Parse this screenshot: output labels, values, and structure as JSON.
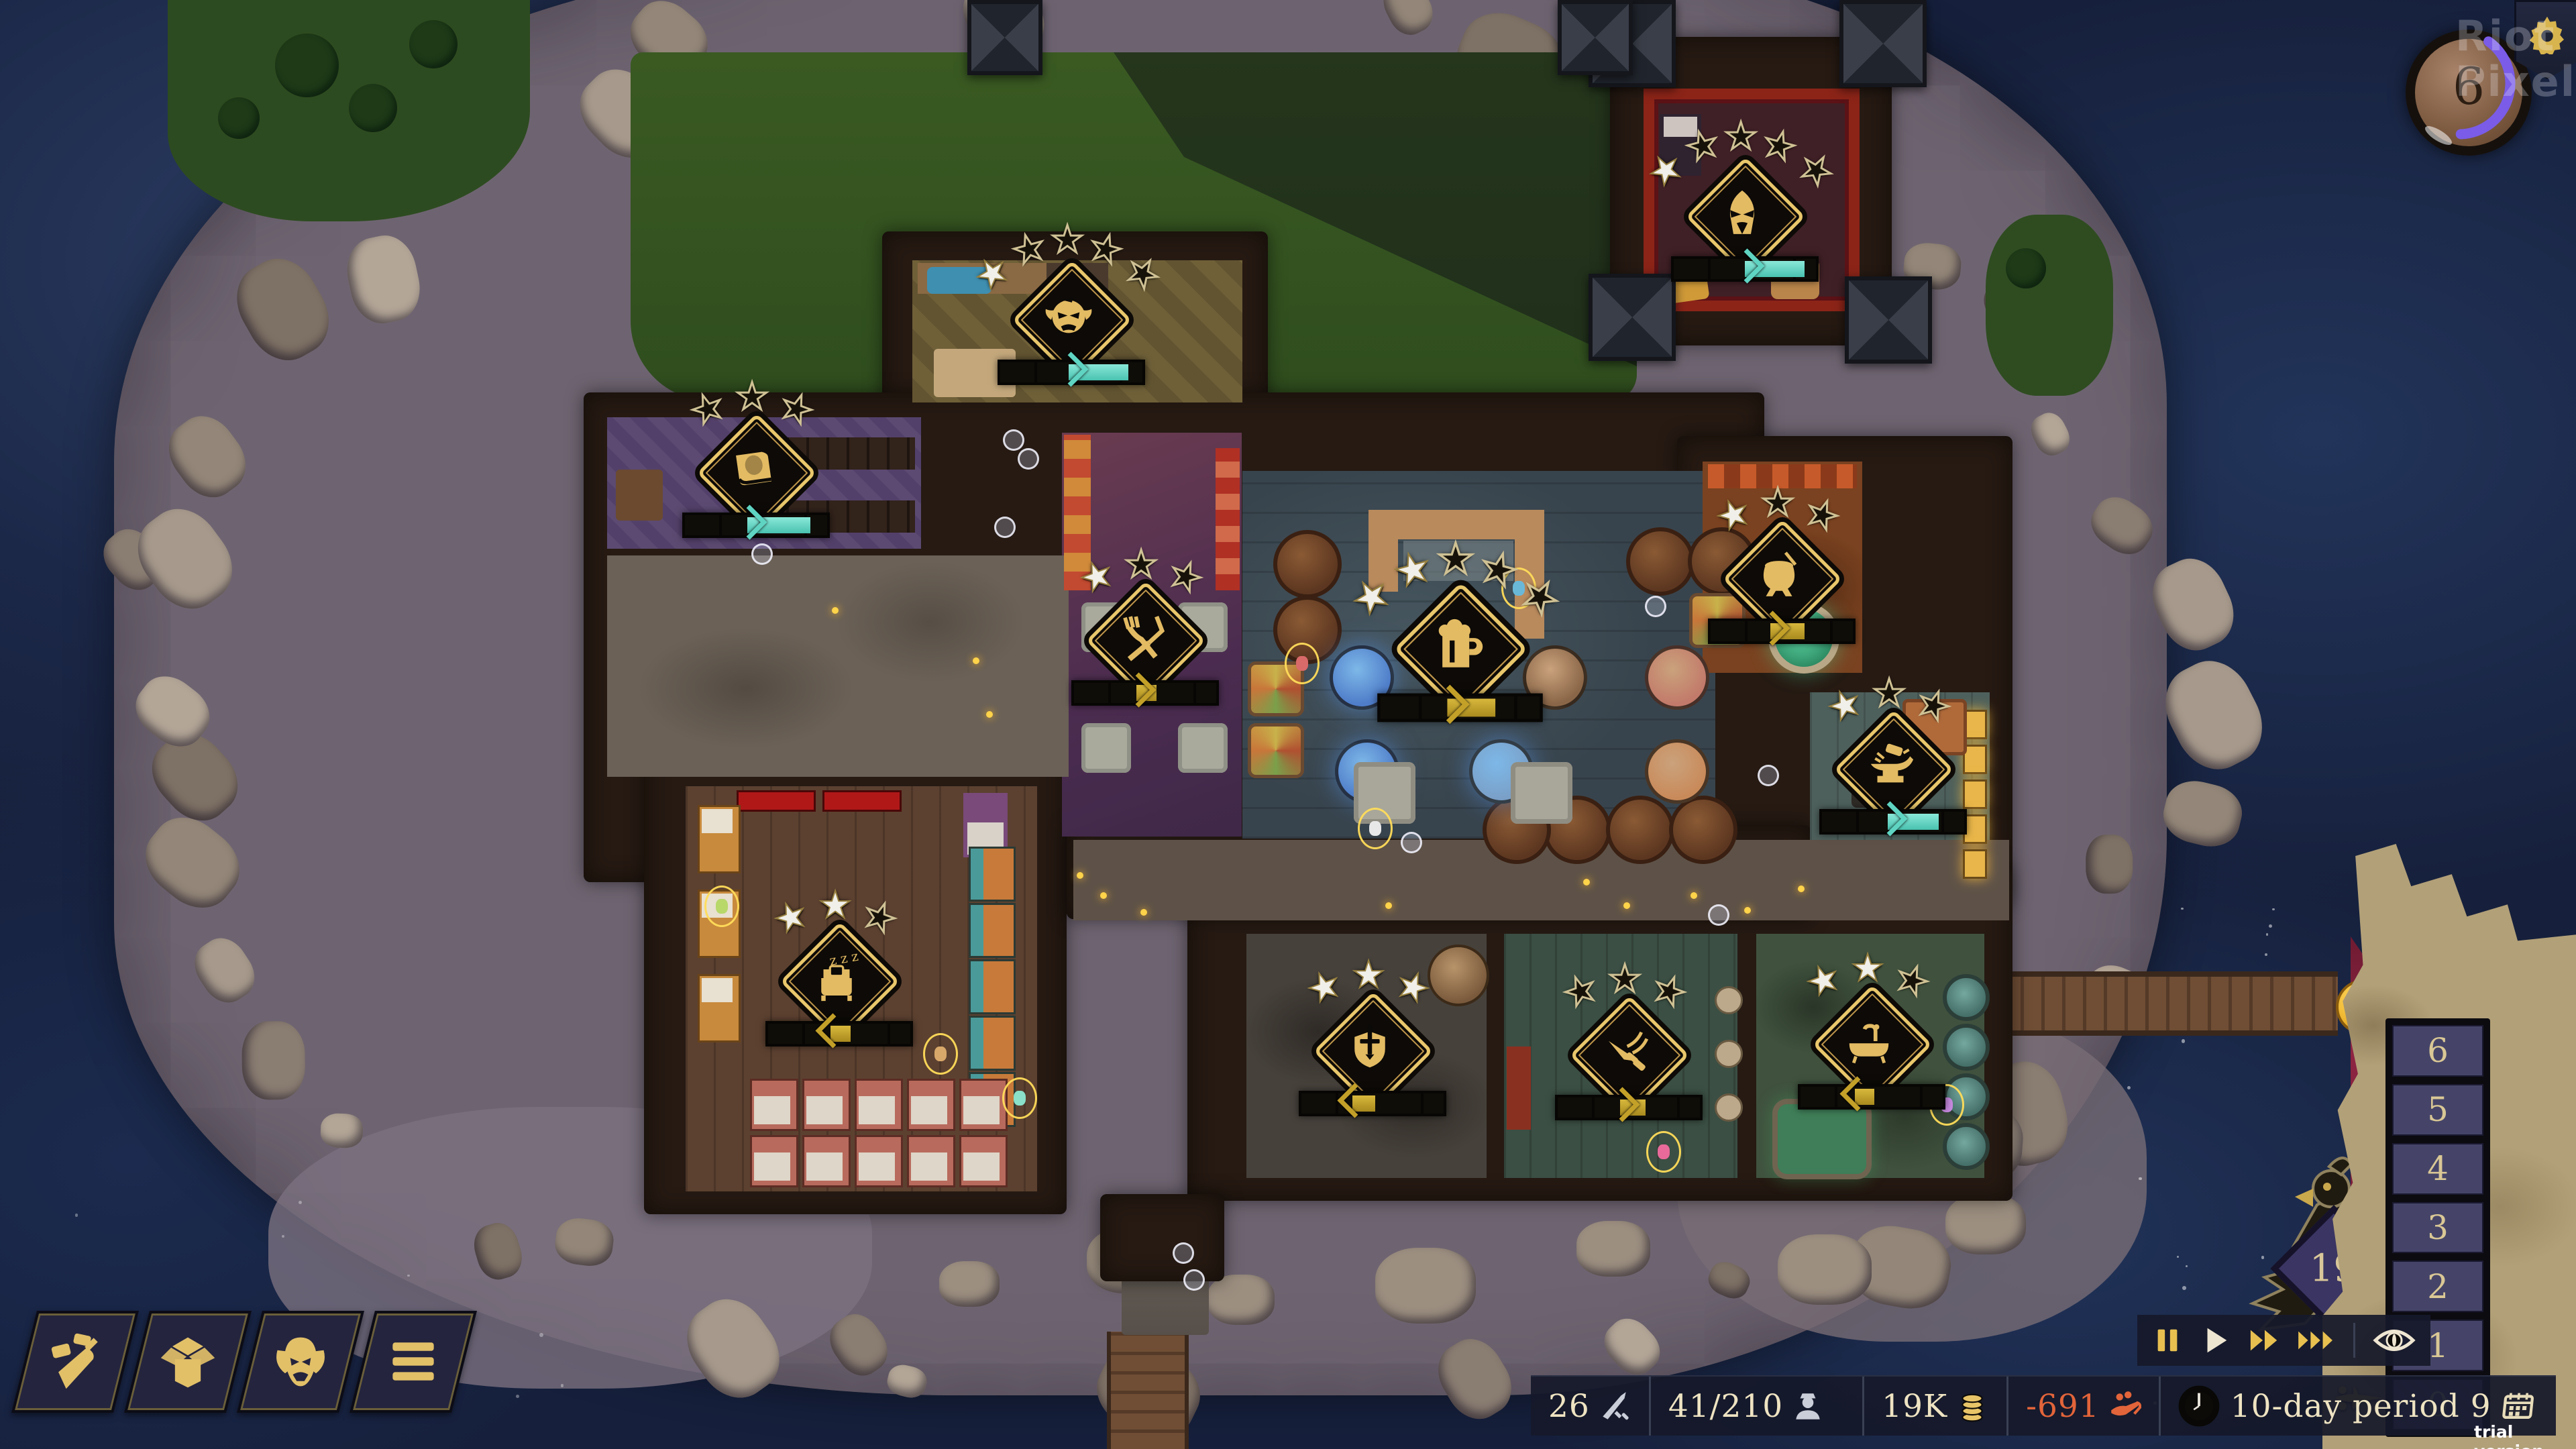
{
  "scene": {
    "rooms": [
      {
        "name": "guest-room",
        "icon": "hooded-wizard",
        "stars_total": 5,
        "stars_filled": 1,
        "bar": {
          "color": "teal",
          "pct": 50,
          "fill_to": 92,
          "dir": "right"
        }
      },
      {
        "name": "kitchen",
        "icon": "ogre-face",
        "stars_total": 5,
        "stars_filled": 1,
        "bar": {
          "color": "teal",
          "pct": 48,
          "fill_to": 90,
          "dir": "right"
        }
      },
      {
        "name": "library",
        "icon": "book",
        "stars_total": 3,
        "stars_filled": 0,
        "bar": {
          "color": "teal",
          "pct": 44,
          "fill_to": 88,
          "dir": "right"
        }
      },
      {
        "name": "dining-hall",
        "icon": "fork-knife",
        "stars_total": 3,
        "stars_filled": 1,
        "bar": {
          "color": "gold",
          "pct": 44,
          "fill_to": 58,
          "dir": "right"
        }
      },
      {
        "name": "tavern-hall",
        "icon": "beer-mug",
        "stars_total": 5,
        "stars_filled": 2,
        "bar": {
          "color": "gold",
          "pct": 42,
          "fill_to": 72,
          "dir": "right"
        }
      },
      {
        "name": "brewing-room",
        "icon": "cauldron",
        "stars_total": 3,
        "stars_filled": 1,
        "bar": {
          "color": "gold",
          "pct": 42,
          "fill_to": 66,
          "dir": "right"
        }
      },
      {
        "name": "workshop",
        "icon": "anvil",
        "stars_total": 3,
        "stars_filled": 1,
        "bar": {
          "color": "teal",
          "pct": 46,
          "fill_to": 82,
          "dir": "right"
        }
      },
      {
        "name": "dormitory",
        "icon": "bed",
        "stars_total": 3,
        "stars_filled": 2,
        "bar": {
          "color": "gold",
          "pct": 44,
          "fill_to": 58,
          "dir": "left"
        }
      },
      {
        "name": "guard-room",
        "icon": "sword-shield",
        "stars_total": 3,
        "stars_filled": 3,
        "bar": {
          "color": "gold",
          "pct": 36,
          "fill_to": 52,
          "dir": "left"
        }
      },
      {
        "name": "game-room",
        "icon": "thrown-dagger",
        "stars_total": 3,
        "stars_filled": 0,
        "bar": {
          "color": "gold",
          "pct": 44,
          "fill_to": 62,
          "dir": "right"
        }
      },
      {
        "name": "bathhouse",
        "icon": "bathtub",
        "stars_total": 3,
        "stars_filled": 2,
        "bar": {
          "color": "gold",
          "pct": 38,
          "fill_to": 52,
          "dir": "left"
        }
      }
    ],
    "bird_sign_value": "19",
    "alert": {
      "emoji": "confused-face",
      "question_mark": "?",
      "badge_icon": "hooded-figure-seal"
    }
  },
  "hud": {
    "top_right": {
      "speed_value": "6",
      "gear_icon": "gear"
    },
    "watermark": {
      "line1": "Riot",
      "line2": "Pixels"
    },
    "build_menu": [
      {
        "icon": "trowel"
      },
      {
        "icon": "box"
      },
      {
        "icon": "gargoyle"
      },
      {
        "icon": "menu-lines"
      }
    ],
    "playback": {
      "buttons": [
        {
          "icon": "pause"
        },
        {
          "icon": "play"
        },
        {
          "icon": "fast-forward"
        },
        {
          "icon": "fastest-forward"
        },
        {
          "icon": "eye"
        }
      ]
    },
    "floor_selector": {
      "levels": [
        "6",
        "5",
        "4",
        "3",
        "2",
        "1",
        "0"
      ],
      "selected": "0",
      "selected_marker_icon": "fleur-pointer"
    },
    "resources": [
      {
        "id": "blades",
        "value": "26",
        "icon": "sword"
      },
      {
        "id": "guests",
        "value": "41/210",
        "icon": "guest"
      },
      {
        "id": "gold",
        "value": "19K",
        "icon": "coins"
      },
      {
        "id": "balance",
        "value": "-691",
        "icon": "hand-coins",
        "color": "#e2643a"
      },
      {
        "id": "period",
        "value": "10-day period 9",
        "icon": "calendar",
        "clock_icon": "clock"
      }
    ],
    "trial_label": "trial version"
  }
}
